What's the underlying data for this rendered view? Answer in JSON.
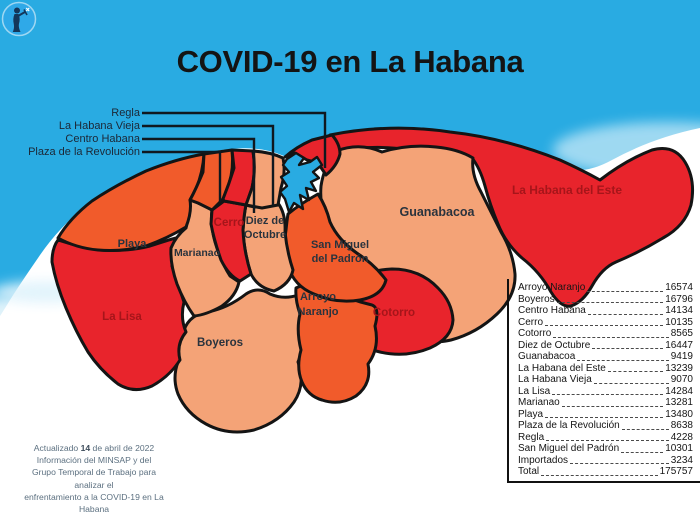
{
  "title": "COVID-19 en La Habana",
  "colors": {
    "sea": "#29ABE2",
    "red": "#E8242C",
    "orange": "#F15B2B",
    "salmon": "#F4A377",
    "outline": "#141414",
    "label_dark": "#2A333D",
    "label_dark_red": "#A6151A",
    "callout_line": "#10181F",
    "logo_blue": "#2FA9E8",
    "logo_figure": "#14365A"
  },
  "icons": {
    "logo": "giraldilla-statue-icon"
  },
  "map": {
    "callout_labels": [
      "Regla",
      "La Habana Vieja",
      "Centro Habana",
      "Plaza de la Revolución"
    ],
    "region_labels": {
      "playa": "Playa",
      "marianao": "Marianao",
      "la_lisa": "La Lisa",
      "cerro": "Cerro",
      "diez_1": "Diez de",
      "diez_2": "Octubre",
      "boyeros": "Boyeros",
      "arroyo_1": "Arroyo",
      "arroyo_2": "Naranjo",
      "san_miguel_1": "San Miguel",
      "san_miguel_2": "del Padrón",
      "guanabacoa": "Guanabacoa",
      "cotorro": "Cotorro",
      "habana_del_este": "La Habana del Este"
    }
  },
  "stats": {
    "rows": [
      {
        "name": "Arroyo Naranjo",
        "value": "16574"
      },
      {
        "name": "Boyeros",
        "value": "16796"
      },
      {
        "name": "Centro Habana",
        "value": "14134"
      },
      {
        "name": "Cerro",
        "value": "10135"
      },
      {
        "name": "Cotorro",
        "value": "8565"
      },
      {
        "name": "Diez de Octubre",
        "value": "16447"
      },
      {
        "name": "Guanabacoa",
        "value": "9419"
      },
      {
        "name": "La Habana del Este",
        "value": "13239"
      },
      {
        "name": "La Habana Vieja",
        "value": "9070"
      },
      {
        "name": "La Lisa",
        "value": "14284"
      },
      {
        "name": "Marianao",
        "value": "13281"
      },
      {
        "name": "Playa",
        "value": "13480"
      },
      {
        "name": "Plaza de la Revolución",
        "value": "8638"
      },
      {
        "name": "Regla",
        "value": "4228"
      },
      {
        "name": "San Miguel del Padrón",
        "value": "10301"
      },
      {
        "name": "Importados",
        "value": "3234"
      },
      {
        "name": "Total",
        "value": "175757"
      }
    ]
  },
  "credit": {
    "line1_prefix": "Actualizado ",
    "line1_date": "14",
    "line1_suffix": " de abril de 2022",
    "line2": "Información del MINSAP y del",
    "line3": "Grupo Temporal de Trabajo para analizar el",
    "line4": "enfrentamiento a la COVID-19 en La Habana"
  }
}
